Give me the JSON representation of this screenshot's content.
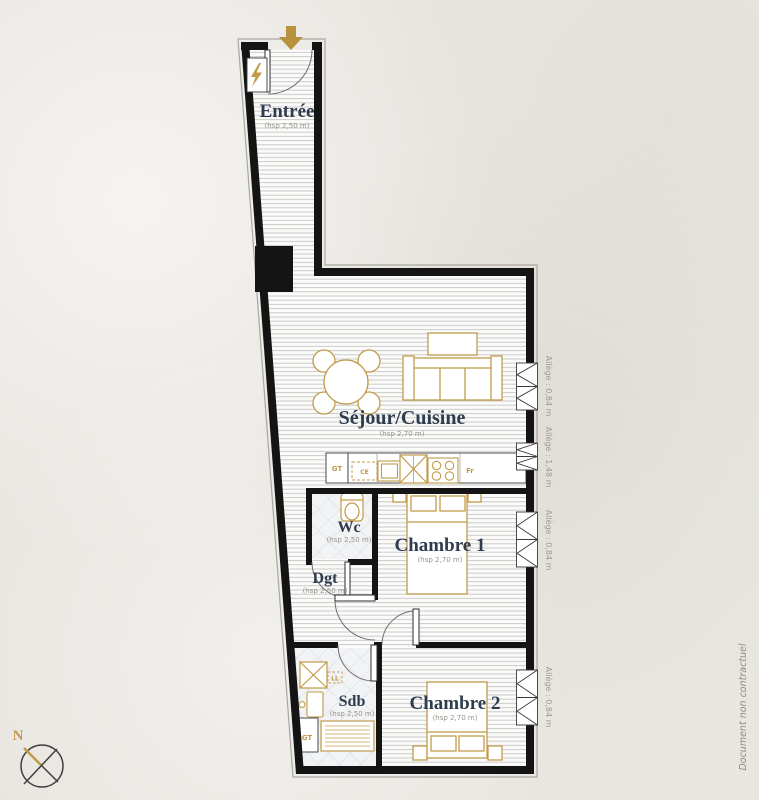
{
  "meta": {
    "doc_note": "Document non contractuel",
    "north_label": "N"
  },
  "rooms": {
    "entree": {
      "name": "Entrée",
      "hsp": "(hsp 2,50 m)"
    },
    "sejour": {
      "name": "Séjour/Cuisine",
      "hsp": "(hsp 2,70 m)"
    },
    "wc": {
      "name": "Wc",
      "hsp": "(hsp 2,50 m)"
    },
    "chambre1": {
      "name": "Chambre 1",
      "hsp": "(hsp 2,70 m)"
    },
    "dgt": {
      "name": "Dgt",
      "hsp": "(hsp 2,50 m)"
    },
    "sdb": {
      "name": "Sdb",
      "hsp": "(hsp 2,50 m)"
    },
    "chambre2": {
      "name": "Chambre 2",
      "hsp": "(hsp 2,70 m)"
    }
  },
  "windows": [
    {
      "label": "Allège : 0,84 m"
    },
    {
      "label": "Allège : 1,48 m"
    },
    {
      "label": "Allège : 0,84 m"
    },
    {
      "label": "Allège : 0,84 m"
    }
  ],
  "equipment": {
    "gt_kitchen": "GT",
    "ce": "CE",
    "fridge": "Fr",
    "ll": "LL",
    "gt_sdb": "GT"
  },
  "icons": {
    "entrance_arrow": "entrance-direction-arrow",
    "lightning": "electrical-panel-bolt",
    "compass": "north-compass"
  },
  "colors": {
    "wall": "#141414",
    "gold": "#c19b4a",
    "label": "#2e3c4e",
    "muted": "#97938c",
    "paper": "#e9e6e1"
  }
}
